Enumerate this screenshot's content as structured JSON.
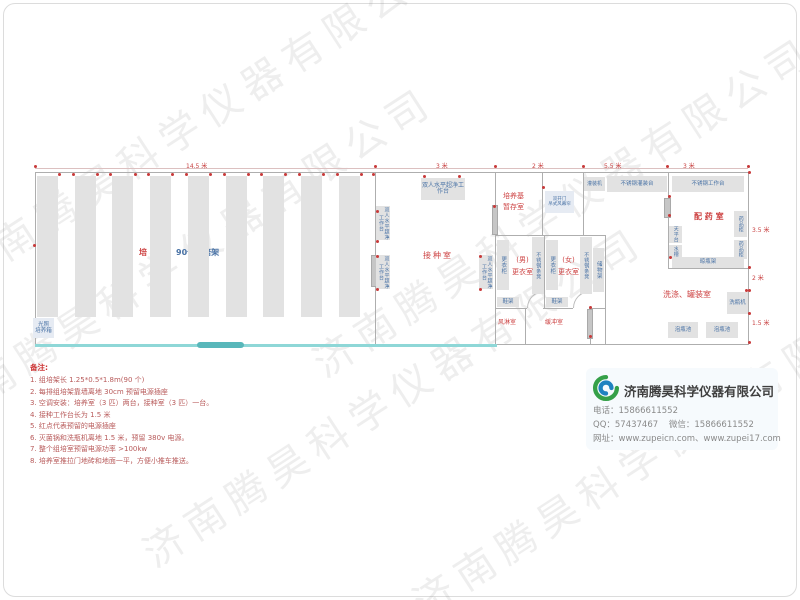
{
  "watermark": {
    "text": "济南腾昊科学仪器有限公司"
  },
  "plan": {
    "dims_top": [
      "14.5 米",
      "3 米",
      "2 米",
      "5.5 米",
      "3 米"
    ],
    "dims_right": [
      "3.5 米",
      "2 米",
      "1.5 米"
    ],
    "labels": {
      "culture_red": "培 养 室",
      "culture_blue": "90个组培架",
      "aisle": "过道0.6米",
      "incubator_l1": "光照",
      "incubator_l2": "培养箱",
      "inoculation": "接种室",
      "bench": "双人水平超净工作台",
      "medium_l1": "培养基",
      "medium_l2": "暂存室",
      "door_l1": "双开门",
      "door_l2": "吊式风幕帘",
      "locker": "更衣柜",
      "ss_bench": "不锈钢条凳",
      "men_l1": "(男)",
      "men_l2": "更衣室",
      "women_l1": "(女)",
      "women_l2": "更衣室",
      "storage": "储物架",
      "shoe_rack": "鞋架",
      "air_shower": "风淋室",
      "buffer": "缓冲室",
      "filling_machine": "灌装机",
      "filling_table": "不锈钢灌装台",
      "work_table": "不锈钢工作台",
      "pharmacy": "配 药 室",
      "med_cabinet": "药品柜",
      "balance": "天平台",
      "sink": "水槽",
      "dry_rack": "晾瓶架",
      "washing": "洗涤、罐装室",
      "washer": "洗瓶机",
      "pool": "泡瓶池"
    }
  },
  "notes": {
    "title": "备注:",
    "items": [
      "1.  组培架长 1.25*0.5*1.8m(90 个)",
      "2.  每排组培架靠墙离地 30cm 预留电源插座",
      "3.  空调安装：培养室（3 匹）两台，接种室（3 匹）一台。",
      "4.  接种工作台长为 1.5 米",
      "5.  红点代表预留的电源插座",
      "6.  灭菌锅和洗瓶机离地 1.5 米，预留 380v 电源。",
      "7.  整个组培室预留电源功率 >100kw",
      "8.  培养室推拉门地砖和地面一平，方便小推车推送。"
    ]
  },
  "company": {
    "name": "济南腾昊科学仪器有限公司",
    "phone_label": "电话：",
    "phone": "15866611552",
    "qq_label": "QQ：",
    "qq": "57437467",
    "wechat_label": "微信：",
    "wechat": "15866611552",
    "web_label": "网址：",
    "urls": "www.zupeicn.com、www.zupei17.com"
  }
}
